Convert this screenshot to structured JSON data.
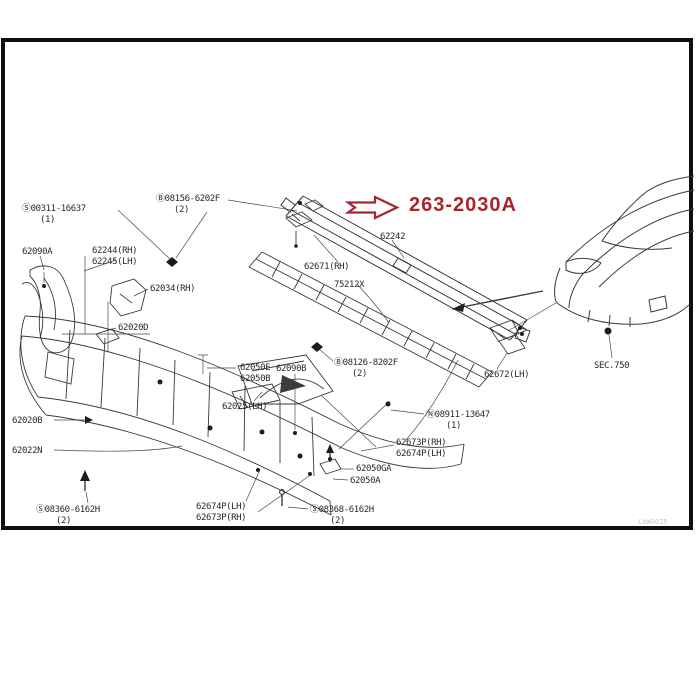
{
  "highlight": {
    "label": "263-2030A",
    "color": "#a6262c"
  },
  "section_reference": "SEC.750",
  "watermark": {
    "text": "LbWA025"
  },
  "colors": {
    "background": "#ffffff",
    "frame": "#0f0f0f",
    "line_art": "#3a3a3a",
    "label_text": "#2a2a2a",
    "highlight": "#a6262c"
  },
  "callouts": [
    {
      "text": "Ⓢ00311-16637",
      "x": 22,
      "y": 204
    },
    {
      "text": "(1)",
      "x": 40,
      "y": 215
    },
    {
      "text": "Ⓑ08156-6202F",
      "x": 156,
      "y": 194
    },
    {
      "text": "(2)",
      "x": 174,
      "y": 205
    },
    {
      "text": "62090A",
      "x": 22,
      "y": 247
    },
    {
      "text": "62244(RH)",
      "x": 92,
      "y": 246
    },
    {
      "text": "62245(LH)",
      "x": 92,
      "y": 257
    },
    {
      "text": "62034(RH)",
      "x": 150,
      "y": 284
    },
    {
      "text": "62020D",
      "x": 118,
      "y": 323
    },
    {
      "text": "62242",
      "x": 380,
      "y": 232
    },
    {
      "text": "62671(RH)",
      "x": 304,
      "y": 262
    },
    {
      "text": "75212X",
      "x": 334,
      "y": 280
    },
    {
      "text": "62050E",
      "x": 240,
      "y": 363
    },
    {
      "text": "62050B",
      "x": 240,
      "y": 374
    },
    {
      "text": "62090B",
      "x": 276,
      "y": 364
    },
    {
      "text": "Ⓑ08126-8202F",
      "x": 334,
      "y": 358
    },
    {
      "text": "(2)",
      "x": 352,
      "y": 369
    },
    {
      "text": "62025(LH)",
      "x": 222,
      "y": 402
    },
    {
      "text": "62672(LH)",
      "x": 484,
      "y": 370
    },
    {
      "text": "Ⓝ08911-13647",
      "x": 426,
      "y": 410
    },
    {
      "text": "(1)",
      "x": 446,
      "y": 421
    },
    {
      "text": "62673P(RH)",
      "x": 396,
      "y": 438
    },
    {
      "text": "62674P(LH)",
      "x": 396,
      "y": 449
    },
    {
      "text": "62050GA",
      "x": 356,
      "y": 464
    },
    {
      "text": "62050A",
      "x": 350,
      "y": 476
    },
    {
      "text": "62020B",
      "x": 12,
      "y": 416
    },
    {
      "text": "62022N",
      "x": 12,
      "y": 446
    },
    {
      "text": "Ⓢ08360-6162H",
      "x": 36,
      "y": 505
    },
    {
      "text": "(2)",
      "x": 56,
      "y": 516
    },
    {
      "text": "62674P(LH)",
      "x": 196,
      "y": 502
    },
    {
      "text": "62673P(RH)",
      "x": 196,
      "y": 513
    },
    {
      "text": "Ⓢ08368-6162H",
      "x": 310,
      "y": 505
    },
    {
      "text": "(2)",
      "x": 330,
      "y": 516
    },
    {
      "text": "SEC.750",
      "x": 594,
      "y": 361
    }
  ]
}
